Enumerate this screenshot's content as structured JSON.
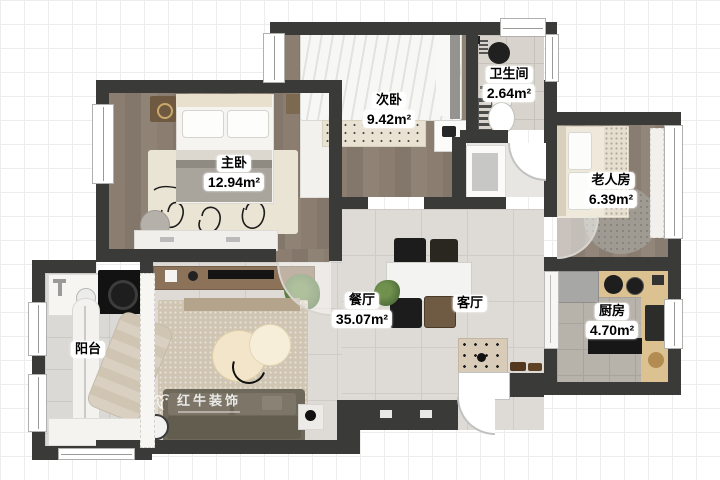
{
  "plan": {
    "title": "apartment-floor-plan",
    "rooms": [
      {
        "key": "master_bedroom",
        "name": "主卧",
        "area": "12.94m²"
      },
      {
        "key": "second_bedroom",
        "name": "次卧",
        "area": "9.42m²"
      },
      {
        "key": "bathroom",
        "name": "卫生间",
        "area": "2.64m²"
      },
      {
        "key": "elder_room",
        "name": "老人房",
        "area": "6.39m²"
      },
      {
        "key": "dining_room",
        "name": "餐厅",
        "area": "35.07m²"
      },
      {
        "key": "living_room",
        "name": "客厅",
        "area": ""
      },
      {
        "key": "kitchen",
        "name": "厨房",
        "area": "4.70m²"
      },
      {
        "key": "balcony",
        "name": "阳台",
        "area": ""
      }
    ],
    "watermark": {
      "brand": "红牛装饰"
    },
    "colors": {
      "wall": "#3a3a38",
      "wood_floor": "#897d6f",
      "tile_floor": "#dedbd6",
      "counter_wood": "#dcc191",
      "label_bg": "#ffffff",
      "label_text": "#000000"
    }
  }
}
